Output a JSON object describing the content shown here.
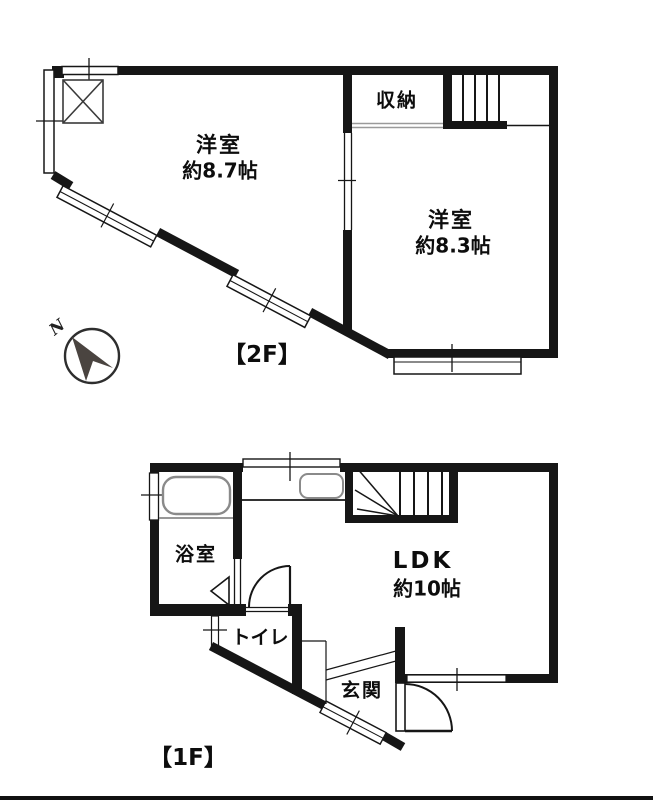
{
  "title": "floor-plan",
  "colors": {
    "wall": "#161616",
    "fixture": "#8a8a8a",
    "slide_door": "#9a9a9a",
    "bg": "#ffffff"
  },
  "compass": {
    "label": "N"
  },
  "floor2": {
    "label": "【2F】",
    "rooms": [
      {
        "name": "洋室",
        "size": "約8.7帖"
      },
      {
        "name": "洋室",
        "size": "約8.3帖"
      }
    ],
    "closet": "収納"
  },
  "floor1": {
    "label": "【1F】",
    "ldk": {
      "name": "LDK",
      "size": "約10帖"
    },
    "bath": "浴室",
    "toilet": "トイレ",
    "entrance": "玄関"
  }
}
